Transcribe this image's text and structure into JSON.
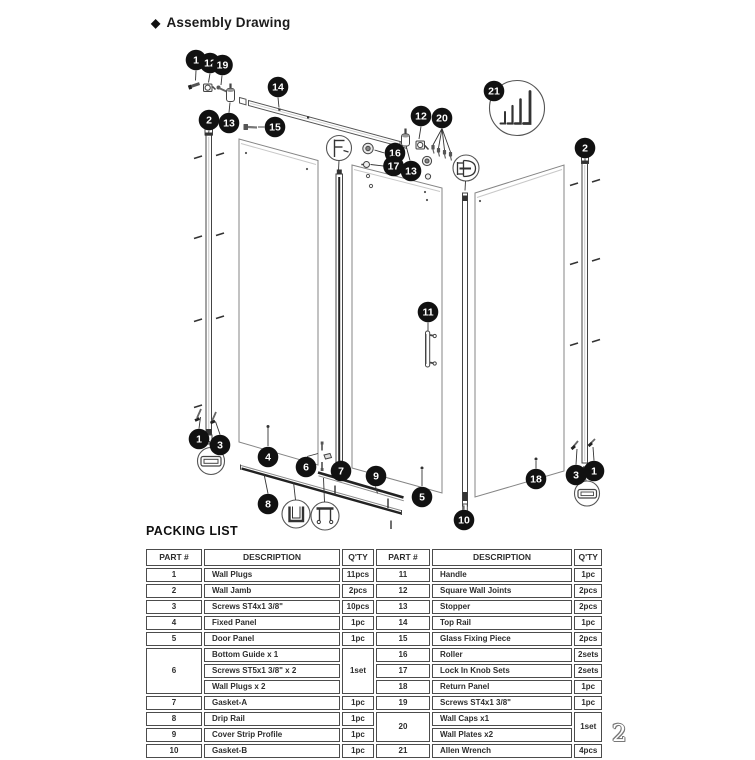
{
  "page": {
    "title_diamond": "◆",
    "title": "Assembly Drawing",
    "page_number": "2"
  },
  "packing_list": {
    "heading": "PACKING LIST",
    "headers": [
      "PART #",
      "DESCRIPTION",
      "Q'TY",
      "PART #",
      "DESCRIPTION",
      "Q'TY"
    ],
    "rows": [
      [
        "1",
        {
          "t": "Wall Plugs",
          "a": "l"
        },
        "11pcs",
        "11",
        {
          "t": "Handle",
          "a": "l"
        },
        "1pc"
      ],
      [
        "2",
        {
          "t": "Wall Jamb",
          "a": "l"
        },
        "2pcs",
        "12",
        {
          "t": "Square Wall Joints",
          "a": "l"
        },
        "2pcs"
      ],
      [
        "3",
        {
          "t": "Screws ST4x1 3/8\"",
          "a": "l"
        },
        "10pcs",
        "13",
        {
          "t": "Stopper",
          "a": "l"
        },
        "2pcs"
      ],
      [
        "4",
        {
          "t": "Fixed Panel",
          "a": "l"
        },
        "1pc",
        "14",
        {
          "t": "Top Rail",
          "a": "l"
        },
        "1pc"
      ],
      [
        "5",
        {
          "t": "Door Panel",
          "a": "l"
        },
        "1pc",
        "15",
        {
          "t": "Glass Fixing Piece",
          "a": "l"
        },
        "2pcs"
      ],
      [
        {
          "t": "6",
          "rs": 3
        },
        {
          "t": "Bottom Guide x 1",
          "a": "l"
        },
        {
          "t": "1set",
          "rs": 3
        },
        "16",
        {
          "t": "Roller",
          "a": "l"
        },
        "2sets"
      ],
      [
        {
          "t": "Screws ST5x1 3/8\" x 2",
          "a": "l"
        },
        "17",
        {
          "t": "Lock In Knob Sets",
          "a": "l"
        },
        "2sets"
      ],
      [
        {
          "t": "Wall Plugs x 2",
          "a": "l"
        },
        "18",
        {
          "t": "Return Panel",
          "a": "l"
        },
        "1pc"
      ],
      [
        "7",
        {
          "t": "Gasket-A",
          "a": "l"
        },
        "1pc",
        "19",
        {
          "t": "Screws ST4x1 3/8\"",
          "a": "l"
        },
        "1pc"
      ],
      [
        "8",
        {
          "t": "Drip Rail",
          "a": "l"
        },
        "1pc",
        {
          "t": "20",
          "rs": 2
        },
        {
          "t": "Wall Caps x1",
          "a": "l"
        },
        {
          "t": "1set",
          "rs": 2
        }
      ],
      [
        "9",
        {
          "t": "Cover Strip Profile",
          "a": "l"
        },
        "1pc",
        {
          "t": "Wall Plates x2",
          "a": "l"
        }
      ],
      [
        "10",
        {
          "t": "Gasket-B",
          "a": "l"
        },
        "1pc",
        "21",
        {
          "t": "Allen Wrench",
          "a": "l"
        },
        "4pcs"
      ]
    ]
  },
  "diagram": {
    "callouts": [
      {
        "n": "1",
        "x": 196,
        "y": 60
      },
      {
        "n": "12",
        "x": 210,
        "y": 63
      },
      {
        "n": "19",
        "x": 222.5,
        "y": 65
      },
      {
        "n": "14",
        "x": 278,
        "y": 87
      },
      {
        "n": "2",
        "x": 209,
        "y": 120
      },
      {
        "n": "13",
        "x": 229,
        "y": 123
      },
      {
        "n": "15",
        "x": 275,
        "y": 127
      },
      {
        "n": "21",
        "x": 494,
        "y": 91
      },
      {
        "n": "12",
        "x": 421,
        "y": 116
      },
      {
        "n": "20",
        "x": 442,
        "y": 118
      },
      {
        "n": "16",
        "x": 395,
        "y": 153
      },
      {
        "n": "17",
        "x": 393.5,
        "y": 166
      },
      {
        "n": "13",
        "x": 411,
        "y": 171
      },
      {
        "n": "2",
        "x": 585,
        "y": 148
      },
      {
        "n": "11",
        "x": 428,
        "y": 312
      },
      {
        "n": "1",
        "x": 199,
        "y": 439
      },
      {
        "n": "3",
        "x": 220,
        "y": 445
      },
      {
        "n": "4",
        "x": 268,
        "y": 457
      },
      {
        "n": "6",
        "x": 306,
        "y": 467
      },
      {
        "n": "7",
        "x": 341,
        "y": 471
      },
      {
        "n": "9",
        "x": 376,
        "y": 476
      },
      {
        "n": "8",
        "x": 268,
        "y": 504
      },
      {
        "n": "5",
        "x": 422,
        "y": 497
      },
      {
        "n": "10",
        "x": 464,
        "y": 520
      },
      {
        "n": "18",
        "x": 536,
        "y": 479
      },
      {
        "n": "3",
        "x": 576,
        "y": 475
      },
      {
        "n": "1",
        "x": 594,
        "y": 471
      }
    ]
  }
}
